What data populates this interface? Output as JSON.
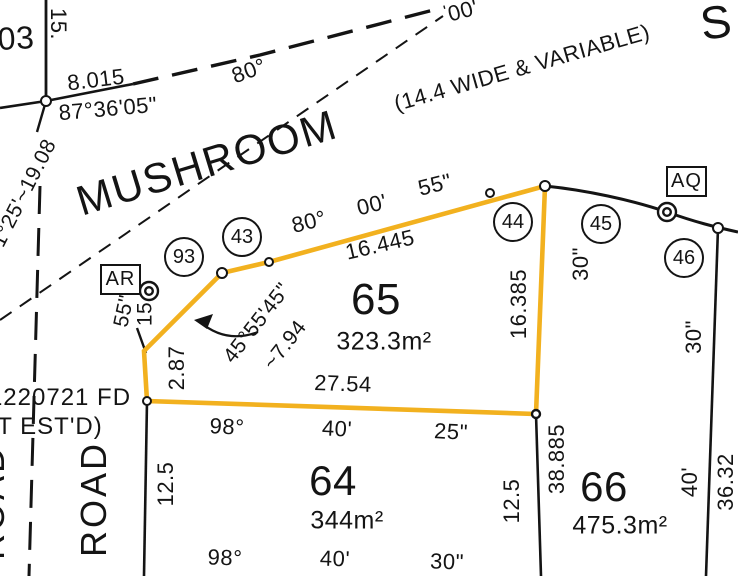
{
  "highlight_color": "#F2B11F",
  "streets": {
    "mushroom": "MUSHROOM",
    "mushroom_width_note": "(14.4 WIDE & VARIABLE)",
    "street_partial": "S",
    "road_vertical": "ROAD",
    "road_vertical_clipped": "ROAD"
  },
  "lots": {
    "lot65": {
      "number": "65",
      "area": "323.3m²"
    },
    "lot64": {
      "number": "64",
      "area": "344m²"
    },
    "lot66": {
      "number": "66",
      "area": "475.3m²"
    },
    "lot03_partial": "03"
  },
  "corner_markers": {
    "c93": "93",
    "c43": "43",
    "c44": "44",
    "c45": "45",
    "c46": "46",
    "ar": "AR",
    "aq": "AQ"
  },
  "bearings": {
    "b87": "87°36'05\"",
    "road80": "80°",
    "road00": "00'",
    "top80": "80°",
    "top00": "00'",
    "top55": "55\"",
    "mid98": "98°",
    "mid40": "40'",
    "mid25": "25\"",
    "bot98": "98°",
    "bot40": "40'",
    "bot30": "30\"",
    "diag4555": "45°55'45\"",
    "left125": "1°25'~19.08",
    "ar55": "55\"",
    "e30_right": "30\"",
    "e30_mid": "30\"",
    "e40": "40'"
  },
  "dimensions": {
    "d8015": "8.015",
    "d15top": "15.",
    "d16445": "16.445",
    "d16385": "16.385",
    "d2754": "27.54",
    "d287": "2.87",
    "d794": "~7.94",
    "d15ar": "15",
    "d38885": "38.885",
    "d125w": "12.5",
    "d125e": "12.5",
    "d3632": "36.32"
  },
  "notes": {
    "found_mark": "1220721 FD",
    "not_estd": "T EST'D)"
  }
}
